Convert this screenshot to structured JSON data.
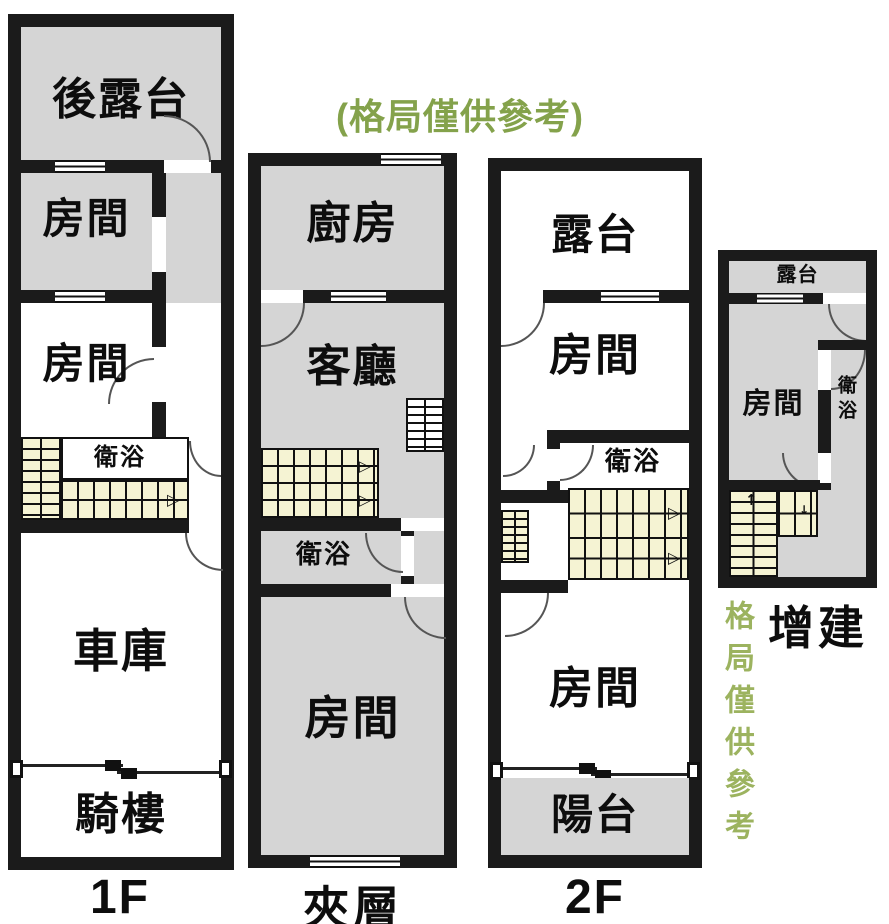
{
  "note": {
    "top": "(格局僅供參考)",
    "side": "格局僅供參考"
  },
  "icons": {
    "arrow_right": "▷",
    "arrow_up": "↑",
    "arrow_down": "↓"
  },
  "plans": {
    "f1": {
      "label": "1F",
      "rooms": {
        "rear_terrace": "後露台",
        "room_a": "房間",
        "room_b": "房間",
        "bath": "衛浴",
        "garage": "車庫",
        "arcade": "騎樓"
      }
    },
    "mezzanine": {
      "label": "夾層",
      "rooms": {
        "kitchen": "廚房",
        "living": "客廳",
        "bath": "衛浴",
        "room": "房間"
      }
    },
    "f2": {
      "label": "2F",
      "rooms": {
        "terrace": "露台",
        "room_a": "房間",
        "bath": "衛浴",
        "room_b": "房間",
        "balcony": "陽台"
      }
    },
    "annex": {
      "label": "增建",
      "rooms": {
        "terrace": "露台",
        "room": "房間",
        "bath": "衛浴"
      }
    }
  },
  "colors": {
    "wall": "#1b1b1b",
    "room_gray": "#d5d5d5",
    "stair_fill": "#f5f3d3",
    "note_green": "#84a24b"
  }
}
